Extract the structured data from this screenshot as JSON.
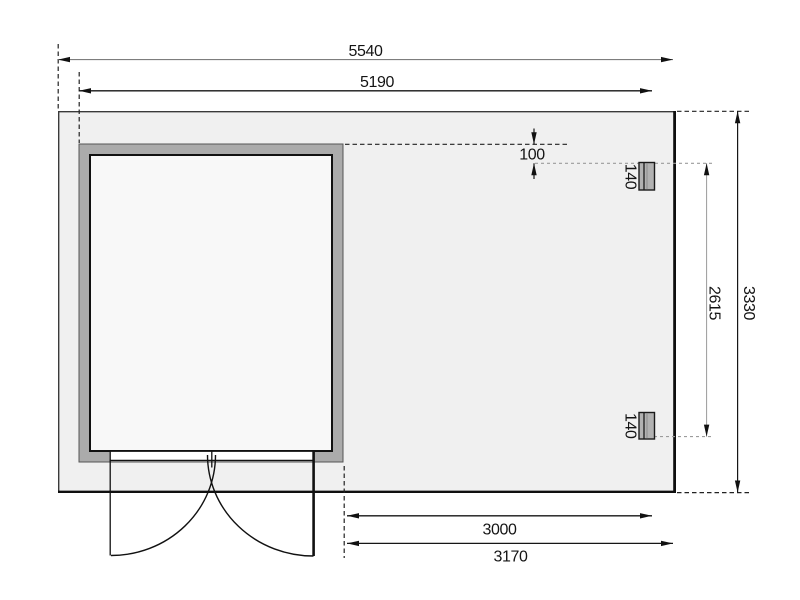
{
  "drawing": {
    "kind": "garden-house floor plan, top view",
    "labels": {
      "overall_width": "5540",
      "cabin_width": "5190",
      "offset_wall_to_post": "100",
      "post_size_top": "140",
      "post_size_bottom": "140",
      "post_span": "2615",
      "overall_depth": "3330",
      "annex_width": "3000",
      "annex_overall_width": "3170"
    },
    "colors": {
      "slab_fill": "#f0f0f0",
      "wall_fill": "#ababab",
      "interior_fill": "#f8f8f8",
      "post_fill": "#b2b2b2",
      "line_dark": "#141414"
    }
  }
}
